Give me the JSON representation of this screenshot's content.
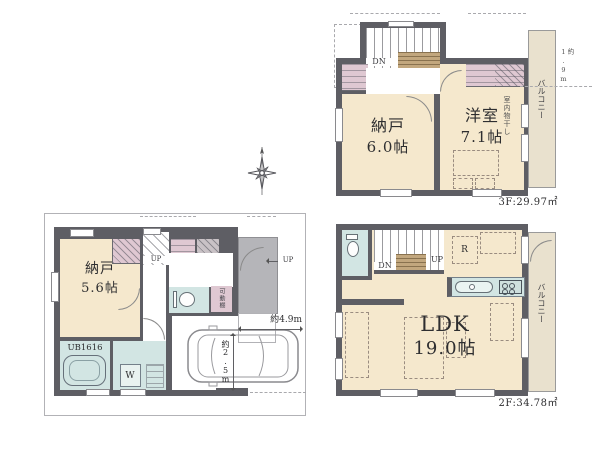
{
  "colors": {
    "wall": "#5e5e64",
    "floor": "#f5e8cd",
    "closet": "#dfc8d2",
    "wet": "#d2e5e3",
    "porch": "#b5b5b9",
    "balcony": "#e9e1ce"
  },
  "f3": {
    "area": "3F:29.97㎡",
    "nando": "納戸",
    "nando_size": "6.0帖",
    "yoshitsu": "洋室",
    "yoshitsu_size": "7.1帖",
    "balcony": "バルコニー",
    "dn": "DN",
    "drying": "室内物干し",
    "dim": "約1.9m"
  },
  "f2": {
    "area": "2F:34.78㎡",
    "ldk": "LDK",
    "ldk_size": "19.0帖",
    "balcony": "バルコニー",
    "up": "UP",
    "dn": "DN",
    "fridge": "R"
  },
  "f1": {
    "nando": "納戸",
    "nando_size": "5.6帖",
    "ub": "UB1616",
    "washer": "W",
    "shelf": "可動棚",
    "up_stairs": "UP",
    "up_entrance": "UP",
    "car_len": "約4.9m",
    "car_dep": "約2.5m"
  }
}
